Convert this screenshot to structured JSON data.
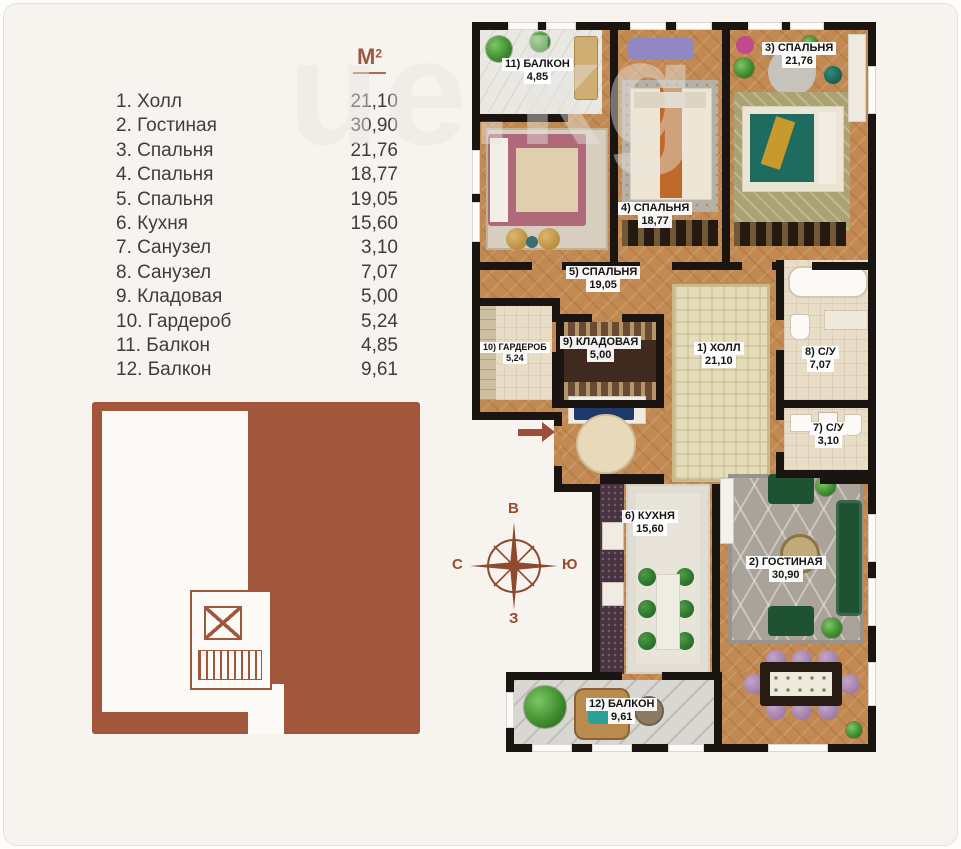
{
  "legend": {
    "unit_base": "М",
    "unit_exponent": "2",
    "items": [
      {
        "label": "1. Холл",
        "area": "21,10"
      },
      {
        "label": "2. Гостиная",
        "area": "30,90"
      },
      {
        "label": "3. Спальня",
        "area": "21,76"
      },
      {
        "label": "4. Спальня",
        "area": "18,77"
      },
      {
        "label": "5. Спальня",
        "area": "19,05"
      },
      {
        "label": "6. Кухня",
        "area": "15,60"
      },
      {
        "label": "7. Санузел",
        "area": "3,10"
      },
      {
        "label": "8. Санузел",
        "area": "7,07"
      },
      {
        "label": "9. Кладовая",
        "area": "5,00"
      },
      {
        "label": "10. Гардероб",
        "area": "5,24"
      },
      {
        "label": "11. Балкон",
        "area": "4,85"
      },
      {
        "label": "12. Балкон",
        "area": "9,61"
      }
    ]
  },
  "plan": {
    "rooms": [
      {
        "label": "11) БАЛКОН",
        "area": "4,85"
      },
      {
        "label": "3) СПАЛЬНЯ",
        "area": "21,76"
      },
      {
        "label": "4) СПАЛЬНЯ",
        "area": "18,77"
      },
      {
        "label": "5) СПАЛЬНЯ",
        "area": "19,05"
      },
      {
        "label": "10) ГАРДЕРОБ",
        "area": "5,24"
      },
      {
        "label": "9) КЛАДОВАЯ",
        "area": "5,00"
      },
      {
        "label": "1) ХОЛЛ",
        "area": "21,10"
      },
      {
        "label": "8) С/У",
        "area": "7,07"
      },
      {
        "label": "7) С/У",
        "area": "3,10"
      },
      {
        "label": "6) КУХНЯ",
        "area": "15,60"
      },
      {
        "label": "2) ГОСТИНАЯ",
        "area": "30,90"
      },
      {
        "label": "12) БАЛКОН",
        "area": "9,61"
      }
    ]
  },
  "compass": {
    "top": "В",
    "left": "С",
    "right": "Ю",
    "bottom": "З"
  },
  "watermark": {
    "text": "ue.kg"
  },
  "colors": {
    "page_background": "#f7f4ef",
    "accent_brown": "#a0573e",
    "building_fill": "#a2573d",
    "wall_black": "#1b1512",
    "wood_floor": "#c28a52",
    "sofa_green": "#1f5230",
    "chair_purple": "#b08cb8",
    "bed_pink": "#b0697a",
    "bed_teal": "#1e6b60",
    "runner_orange": "#bf6a2a",
    "console_navy": "#1d3a6b"
  }
}
